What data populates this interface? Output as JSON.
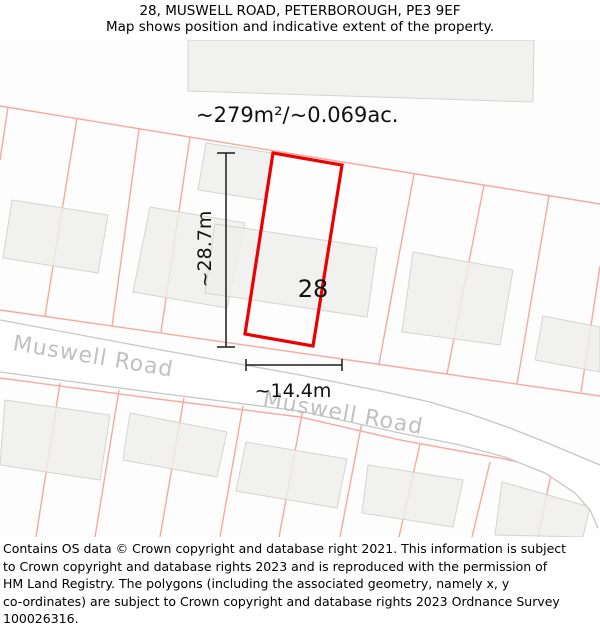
{
  "header": {
    "title": "28, MUSWELL ROAD, PETERBOROUGH, PE3 9EF",
    "subtitle": "Map shows position and indicative extent of the property."
  },
  "map": {
    "area_label": "~279m²/~0.069ac.",
    "plot_number": "28",
    "height_dimension": "~28.7m",
    "width_dimension": "~14.4m",
    "road_name": "Muswell Road"
  },
  "colors": {
    "property_red": "#ee0000",
    "parcel_pink": "#f5a9a1",
    "building_fill": "#eeeeec",
    "building_stroke": "#d4d4d2",
    "road_gray": "#c7c7c7",
    "road_label_gray": "#c0c0c0",
    "dimension_black": "#1d1d1d",
    "map_bg": "#fdfdfd"
  },
  "footer": {
    "lines": [
      "Contains OS data © Crown copyright and database right 2021. This information is subject",
      "to Crown copyright and database rights 2023 and is reproduced with the permission of",
      "HM Land Registry. The polygons (including the associated geometry, namely x, y",
      "co-ordinates) are subject to Crown copyright and database rights 2023 Ordnance Survey",
      "100026316."
    ]
  }
}
